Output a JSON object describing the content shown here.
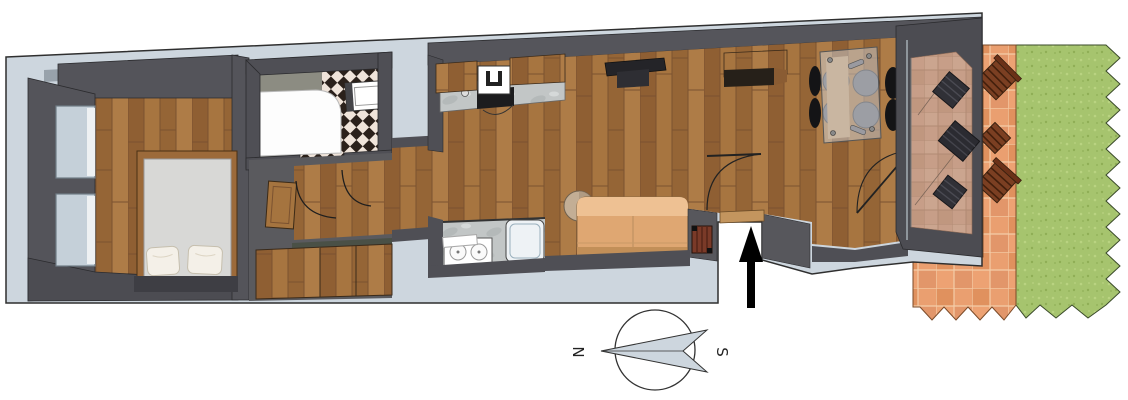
{
  "canvas": {
    "width": 1128,
    "height": 400
  },
  "scene": "apartment-floor-plan",
  "compass": {
    "north_label": "N",
    "south_label": "S"
  },
  "colors": {
    "slab": "#cdd6de",
    "wall": "#4f4f55",
    "wall_light": "#98a2ab",
    "wood_floor": "#9c6a3a",
    "grass": "#a6c46e",
    "terrace_tile": "#e59a68",
    "loggia_tile": "#c79e88",
    "mattress": "#d8d8d6",
    "pillow": "#f4f0e8",
    "sofa": "#dfa772",
    "sofa_back": "#eec193",
    "dining_chair": "#141416",
    "glass": "#cdd2d8",
    "marble": "#c3c7c7",
    "checker_dark": "#2b211b",
    "checker_light": "#f0e4da",
    "outdoor_wood": "#7b3f22",
    "loggia_furniture": "#303036",
    "entrance_arrow": "#000000",
    "compass_needle": "#cdd6de"
  },
  "rooms": [
    {
      "name": "bedroom"
    },
    {
      "name": "bathroom"
    },
    {
      "name": "hallway"
    },
    {
      "name": "corridor"
    },
    {
      "name": "kitchen"
    },
    {
      "name": "laundry"
    },
    {
      "name": "living-room"
    },
    {
      "name": "dining-area"
    },
    {
      "name": "loggia"
    },
    {
      "name": "terrace"
    },
    {
      "name": "garden"
    }
  ],
  "furniture": [
    {
      "name": "double-bed"
    },
    {
      "name": "pillows",
      "count": 2
    },
    {
      "name": "shower-tub"
    },
    {
      "name": "washbasin"
    },
    {
      "name": "wardrobe"
    },
    {
      "name": "kitchen-counter"
    },
    {
      "name": "sink"
    },
    {
      "name": "cooktop"
    },
    {
      "name": "washing-machine-sinks",
      "count": 2
    },
    {
      "name": "shower-cabin"
    },
    {
      "name": "tv"
    },
    {
      "name": "wall-shelf"
    },
    {
      "name": "sofa"
    },
    {
      "name": "side-table"
    },
    {
      "name": "radiator"
    },
    {
      "name": "dining-table"
    },
    {
      "name": "dining-chairs",
      "count": 4
    },
    {
      "name": "loggia-furniture",
      "count": 3
    },
    {
      "name": "garden-furniture",
      "count": 3
    }
  ],
  "markers": [
    {
      "name": "entrance-arrow"
    },
    {
      "name": "compass"
    }
  ]
}
